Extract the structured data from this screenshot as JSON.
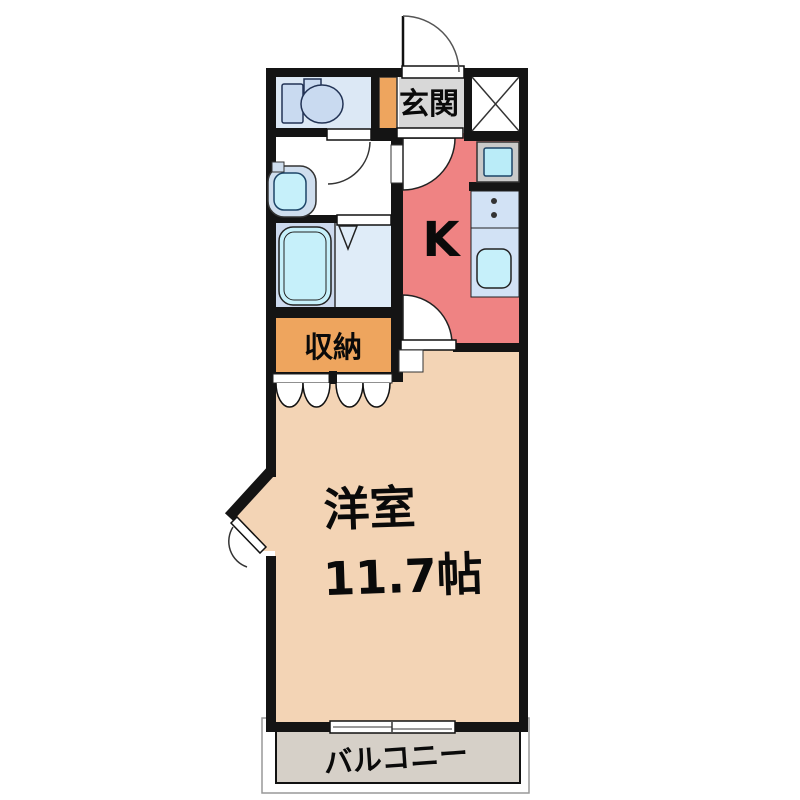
{
  "plan": {
    "genkan_label": "玄関",
    "kitchen_label": "K",
    "storage_label": "収納",
    "main_room_label": "洋室",
    "main_room_size": "11.7帖",
    "balcony_label": "バルコニー"
  },
  "colors": {
    "wall": "#141414",
    "main_room_floor": "#f3d4b5",
    "kitchen_floor": "#ef8383",
    "storage_floor": "#eea55e",
    "entry_step": "#eea55e",
    "genkan_floor": "#d8d8d8",
    "balcony_floor": "#d6d0c8",
    "toilet_floor": "#dce8f5",
    "bath_floor_left": "#ccd9ed",
    "bath_floor_right": "#dfecf8",
    "fixture_cyan": "#c6f0fa",
    "fixture_blue": "#c9daf0",
    "basin_body": "#cfdeee",
    "counter": "#d2e2f5",
    "washer_inner": "#baecf8",
    "washer_frame": "#c9c9c9"
  }
}
